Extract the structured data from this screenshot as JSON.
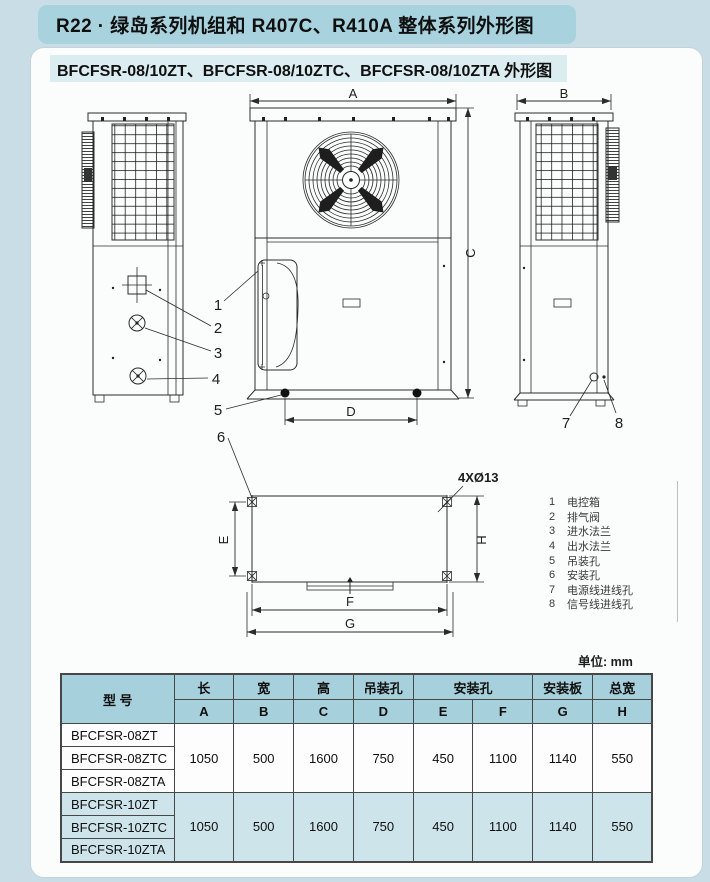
{
  "page": {
    "title": "R22 · 绿岛系列机组和 R407C、R410A 整体系列外形图",
    "subtitle": "BFCFSR-08/10ZT、BFCFSR-08/10ZTC、BFCFSR-08/10ZTA 外形图",
    "unit_label": "单位: mm"
  },
  "drawing": {
    "dims": {
      "A": "A",
      "B": "B",
      "C": "C",
      "D": "D",
      "E": "E",
      "F": "F",
      "G": "G",
      "H": "H"
    },
    "hole_note": "4XØ13",
    "callouts": {
      "c1": "1",
      "c2": "2",
      "c3": "3",
      "c4": "4",
      "c5": "5",
      "c6": "6",
      "c7": "7",
      "c8": "8"
    }
  },
  "legend": {
    "items": [
      {
        "num": "1",
        "label": "电控箱"
      },
      {
        "num": "2",
        "label": "排气阀"
      },
      {
        "num": "3",
        "label": "进水法兰"
      },
      {
        "num": "4",
        "label": "出水法兰"
      },
      {
        "num": "5",
        "label": "吊装孔"
      },
      {
        "num": "6",
        "label": "安装孔"
      },
      {
        "num": "7",
        "label": "电源线进线孔"
      },
      {
        "num": "8",
        "label": "信号线进线孔"
      }
    ]
  },
  "table": {
    "model_header": "型  号",
    "col_groups": [
      {
        "label": "长"
      },
      {
        "label": "宽"
      },
      {
        "label": "高"
      },
      {
        "label": "吊装孔"
      },
      {
        "label": "安装孔"
      },
      {
        "label": "安装板"
      },
      {
        "label": "总宽"
      }
    ],
    "sub_headers": [
      "A",
      "B",
      "C",
      "D",
      "E",
      "F",
      "G",
      "H"
    ],
    "groups": [
      {
        "models": [
          "BFCFSR-08ZT",
          "BFCFSR-08ZTC",
          "BFCFSR-08ZTA"
        ],
        "values": [
          "1050",
          "500",
          "1600",
          "750",
          "450",
          "1100",
          "1140",
          "550"
        ]
      },
      {
        "models": [
          "BFCFSR-10ZT",
          "BFCFSR-10ZTC",
          "BFCFSR-10ZTA"
        ],
        "values": [
          "1050",
          "500",
          "1600",
          "750",
          "450",
          "1100",
          "1140",
          "550"
        ]
      }
    ]
  },
  "colors": {
    "page-bg": "#c9dde6",
    "title-bg": "#a8d3de",
    "subtitle-bg": "#dcedf2",
    "card-bg": "#fbfcfc",
    "table-header-bg": "#a6d0db",
    "table-alt-bg": "#cee4eb",
    "line": "#2b2b2b"
  }
}
